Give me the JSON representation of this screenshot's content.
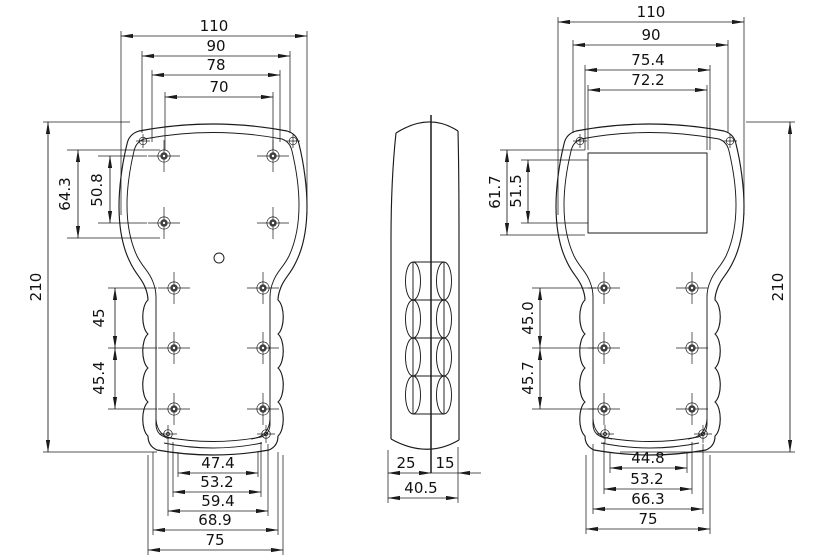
{
  "meta": {
    "drawing_type": "handheld enclosure three-view dimensioned drawing",
    "line_color": "#1b1b1b",
    "background_color": "#ffffff"
  },
  "views": {
    "back": {
      "top_dims": {
        "d110": "110",
        "d90": "90",
        "d78": "78",
        "d70": "70"
      },
      "left_dims": {
        "d210": "210",
        "d64": "64.3",
        "d50": "50.8",
        "d45": "45",
        "d454": "45.4"
      },
      "bottom_dims": {
        "d474": "47.4",
        "d532": "53.2",
        "d594": "59.4",
        "d689": "68.9",
        "d75": "75"
      }
    },
    "side": {
      "bottom_dims": {
        "d25": "25",
        "d15": "15",
        "d405": "40.5"
      }
    },
    "front": {
      "top_dims": {
        "d110": "110",
        "d90": "90",
        "d754": "75.4",
        "d722": "72.2"
      },
      "left_dims": {
        "d617": "61.7",
        "d515": "51.5",
        "d450": "45.0",
        "d457": "45.7"
      },
      "right_dims": {
        "d210": "210"
      },
      "bottom_dims": {
        "d448": "44.8",
        "d532": "53.2",
        "d663": "66.3",
        "d75": "75"
      }
    }
  }
}
